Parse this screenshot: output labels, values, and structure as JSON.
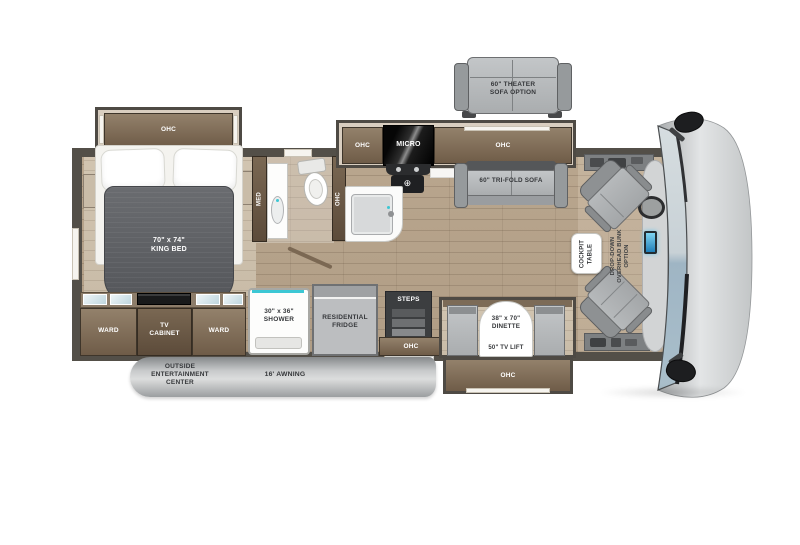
{
  "floorplan": {
    "title": "Class A motorhome floor plan",
    "labels": {
      "theater_sofa": "60\" THEATER\nSOFA OPTION",
      "ohc": "OHC",
      "micro": "MICRO",
      "tri_fold_sofa": "60\" TRI-FOLD SOFA",
      "king_bed": "70\" x 74\"\nKING BED",
      "med": "MED",
      "ward": "WARD",
      "tv_cabinet": "TV\nCABINET",
      "shower": "30\" x 36\"\nSHOWER",
      "fridge": "RESIDENTIAL\nFRIDGE",
      "steps": "STEPS",
      "dinette": "38\" x 70\"\nDINETTE",
      "tv_lift": "50\" TV LIFT",
      "cockpit_table": "COCKPIT\nTABLE",
      "bunk_option": "DROP-DOWN\nOVERHEAD BUNK\nOPTION",
      "outside_entertainment": "OUTSIDE\nENTERTAINMENT\nCENTER",
      "awning": "16' AWNING",
      "burner_icon": "⊕"
    },
    "palette": {
      "cabinet_brown": "#7c6a55",
      "wall_dark": "#534f48",
      "floor_wood": "#b4a189",
      "furniture_gray": "#b2b5b7",
      "blanket_gray": "#5d5f63",
      "teal_accent": "#3cc7d4",
      "windshield_blue": "#a3b8c6",
      "awning_gray": "#c9cbcc",
      "screen_blue": "#2f9fd6"
    }
  }
}
